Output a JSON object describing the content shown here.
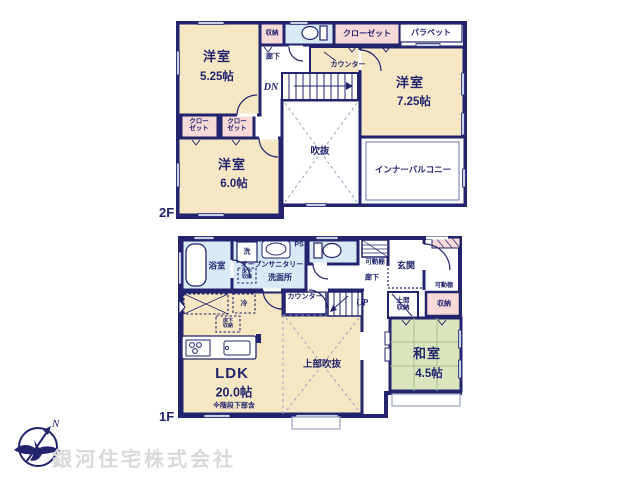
{
  "watermark": {
    "company": "銀河住宅株式会社"
  },
  "compass": {
    "north": "N"
  },
  "floor2": {
    "label": "2F",
    "yoshitsu_525": {
      "name": "洋室",
      "size": "5.25帖"
    },
    "yoshitsu_725": {
      "name": "洋室",
      "size": "7.25帖"
    },
    "yoshitsu_60": {
      "name": "洋室",
      "size": "6.0帖"
    },
    "storage": "収納",
    "closet_top": "クローゼット",
    "closet_a": "クローゼット",
    "closet_b": "クローゼット",
    "parapet": "パラペット",
    "hallway": "廊下",
    "counter": "カウンター",
    "stairs": "DN",
    "void": "吹抜",
    "inner_balcony": "インナーバルコニー"
  },
  "floor1": {
    "label": "1F",
    "bathroom": "浴室",
    "laundry": "洗",
    "sanitary_line1": "オープンサニタリー",
    "sanitary_line2": "洗面所",
    "pipe_space": "PS",
    "shelf_hall": "可動棚",
    "shelf_entry": "可動棚",
    "hallway": "廊下",
    "entrance": "玄関",
    "counter": "カウンター",
    "stairs": "UP",
    "doma_storage": "土間収納",
    "storage": "収納",
    "washitsu": {
      "name": "和室",
      "size": "4.5帖"
    },
    "ldk": {
      "name": "LDK",
      "size": "20.0帖",
      "note": "※階段下部含"
    },
    "upper_void": "上部吹抜",
    "fridge": "冷",
    "underfloor_a": "床下収納",
    "underfloor_b": "床下収納"
  },
  "colors": {
    "wall": "#23246e",
    "room_cream": "#f6e7c4",
    "closet_pink": "#f7d9d8",
    "wet_blue": "#d7eaf6",
    "tatami_green": "#dbe5bd"
  }
}
